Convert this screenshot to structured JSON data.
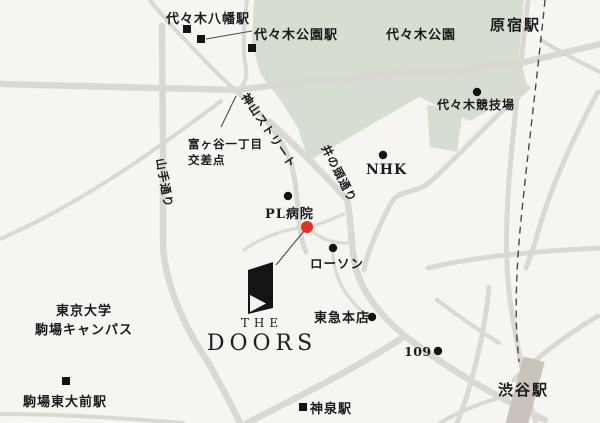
{
  "map": {
    "title": "THE DOORS access map",
    "colors": {
      "background": "#f7f5f2",
      "road": "#dad8d3",
      "park_green": "#d6ddd1",
      "rail": "#4a4a4a",
      "marker_black": "#141414",
      "marker_red": "#e13228",
      "station_building": "#c9c3bb",
      "text": "#1b1b1b"
    },
    "labels": {
      "yoyogi_hachiman_station": "代々木八幡駅",
      "yoyogi_koen_station": "代々木公園駅",
      "yoyogi_park": "代々木公園",
      "harajuku_station": "原宿駅",
      "yoyogi_stadium": "代々木競技場",
      "nhk": "NHK",
      "kamiyama_street": "神山ストリート",
      "inokashira_dori": "井の頭通り",
      "tomigaya_crossing_line1": "富ヶ谷一丁目",
      "tomigaya_crossing_line2": "交差点",
      "yamate_dori": "山手通り",
      "pl_hospital": "PL病院",
      "lawson": "ローソン",
      "tokyu_honten": "東急本店",
      "shibuya_109": "109",
      "shinsen_station": "神泉駅",
      "shibuya_station": "渋谷駅",
      "todai_line1": "東京大学",
      "todai_line2": "駒場キャンパス",
      "komaba_todaimae_station": "駒場東大前駅"
    },
    "logo": {
      "line1": "THE",
      "line2": "DOORS"
    }
  }
}
